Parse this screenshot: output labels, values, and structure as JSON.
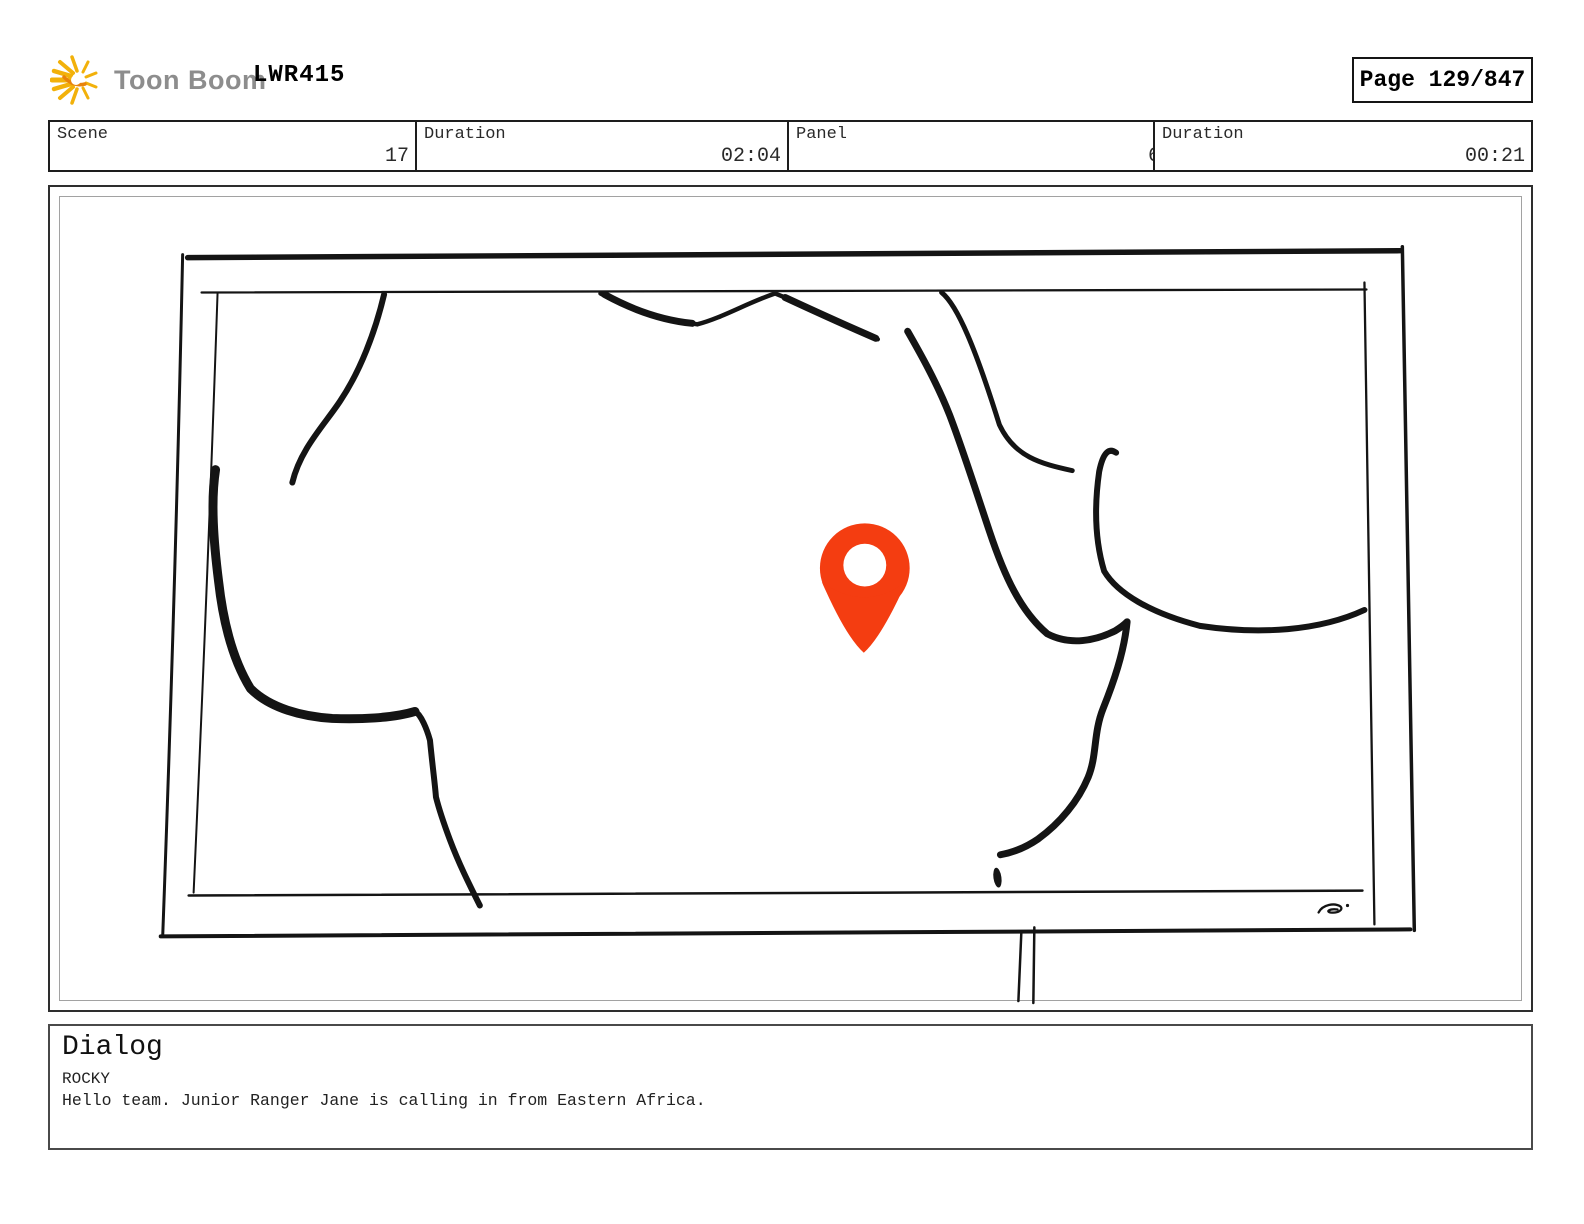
{
  "header": {
    "brand": "Toon Boom",
    "production_title": "LWR415",
    "page_label": "Page 129/847"
  },
  "info_bar": {
    "cells": [
      {
        "label": "Scene",
        "value": "17"
      },
      {
        "label": "Duration",
        "value": "02:04"
      },
      {
        "label": "Panel",
        "value": "6"
      },
      {
        "label": "Duration",
        "value": "00:21"
      }
    ]
  },
  "panel": {
    "description": "Hand-drawn sketch of a TV screen showing an outline map of Africa with a red location pin over Eastern Africa; TV stand legs below and a small artist squiggle at bottom right",
    "pin_color": "#F43D11",
    "ink_color": "#141414"
  },
  "dialog": {
    "heading": "Dialog",
    "character": "ROCKY",
    "line": "Hello team. Junior Ranger Jane is calling in from Eastern Africa."
  },
  "colors": {
    "brand_gray": "#8d8d8d",
    "logo_yellow": "#F2B10A",
    "logo_orange": "#E8830B"
  }
}
